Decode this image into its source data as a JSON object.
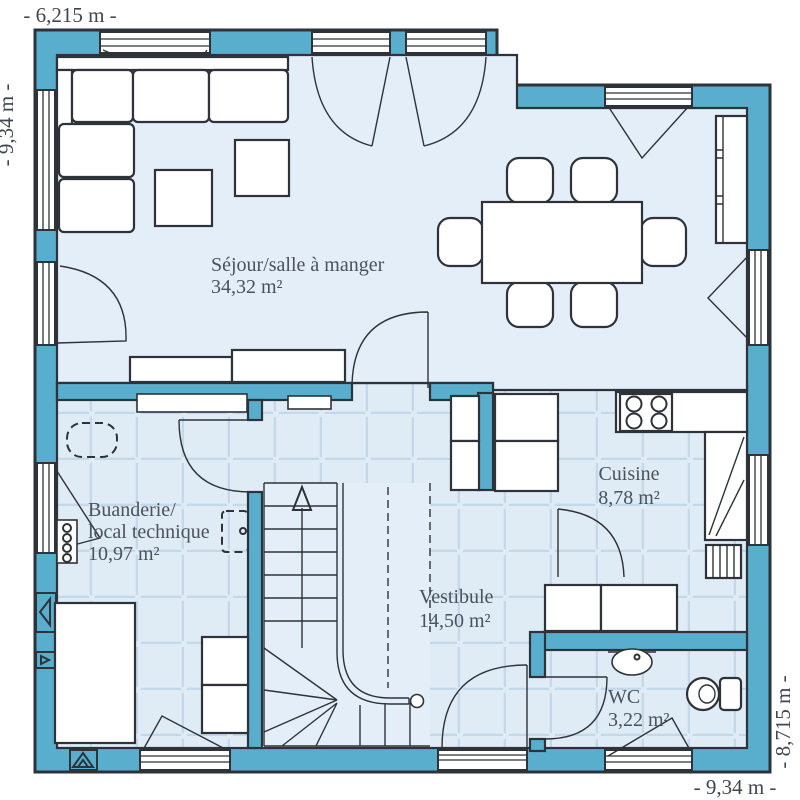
{
  "plan": {
    "type": "house-ground-floor-plan",
    "dimensions": {
      "top": "- 6,215 m -",
      "left": "- 9,34 m -",
      "right": "- 8,715 m -",
      "bottom": "- 9,34 m -"
    },
    "rooms": [
      {
        "id": "sejour-salle-a-manger",
        "name": "Séjour/salle à manger",
        "area": "34,32 m²"
      },
      {
        "id": "buanderie-local-technique",
        "name_line1": "Buanderie/",
        "name_line2": "local technique",
        "area": "10,97 m²"
      },
      {
        "id": "cuisine",
        "name": "Cuisine",
        "area": "8,78 m²"
      },
      {
        "id": "vestibule",
        "name": "Vestibule",
        "area": "14,50 m²"
      },
      {
        "id": "wc",
        "name": "WC",
        "area": "3,22 m²"
      }
    ],
    "colors": {
      "wall": "#59aecd",
      "outline": "#2d3338",
      "floor": "#e4eef8",
      "tile_floor": "#dfebf5",
      "tile_joint": "#c3d9ea",
      "label": "#4a525a",
      "background": "#ffffff"
    },
    "fixtures": [
      "corner-sofa",
      "side-tables",
      "sideboard",
      "dining-table",
      "dining-chairs",
      "tall-cabinet",
      "cooktop",
      "kitchen-counters",
      "kitchen-tall-units",
      "radiator",
      "hall-closet",
      "shelf",
      "heating-manifold",
      "storage-cupboard",
      "washer-dryer-stack",
      "planned-appliances",
      "staircase",
      "washbasin",
      "toilet",
      "air-vent"
    ]
  }
}
